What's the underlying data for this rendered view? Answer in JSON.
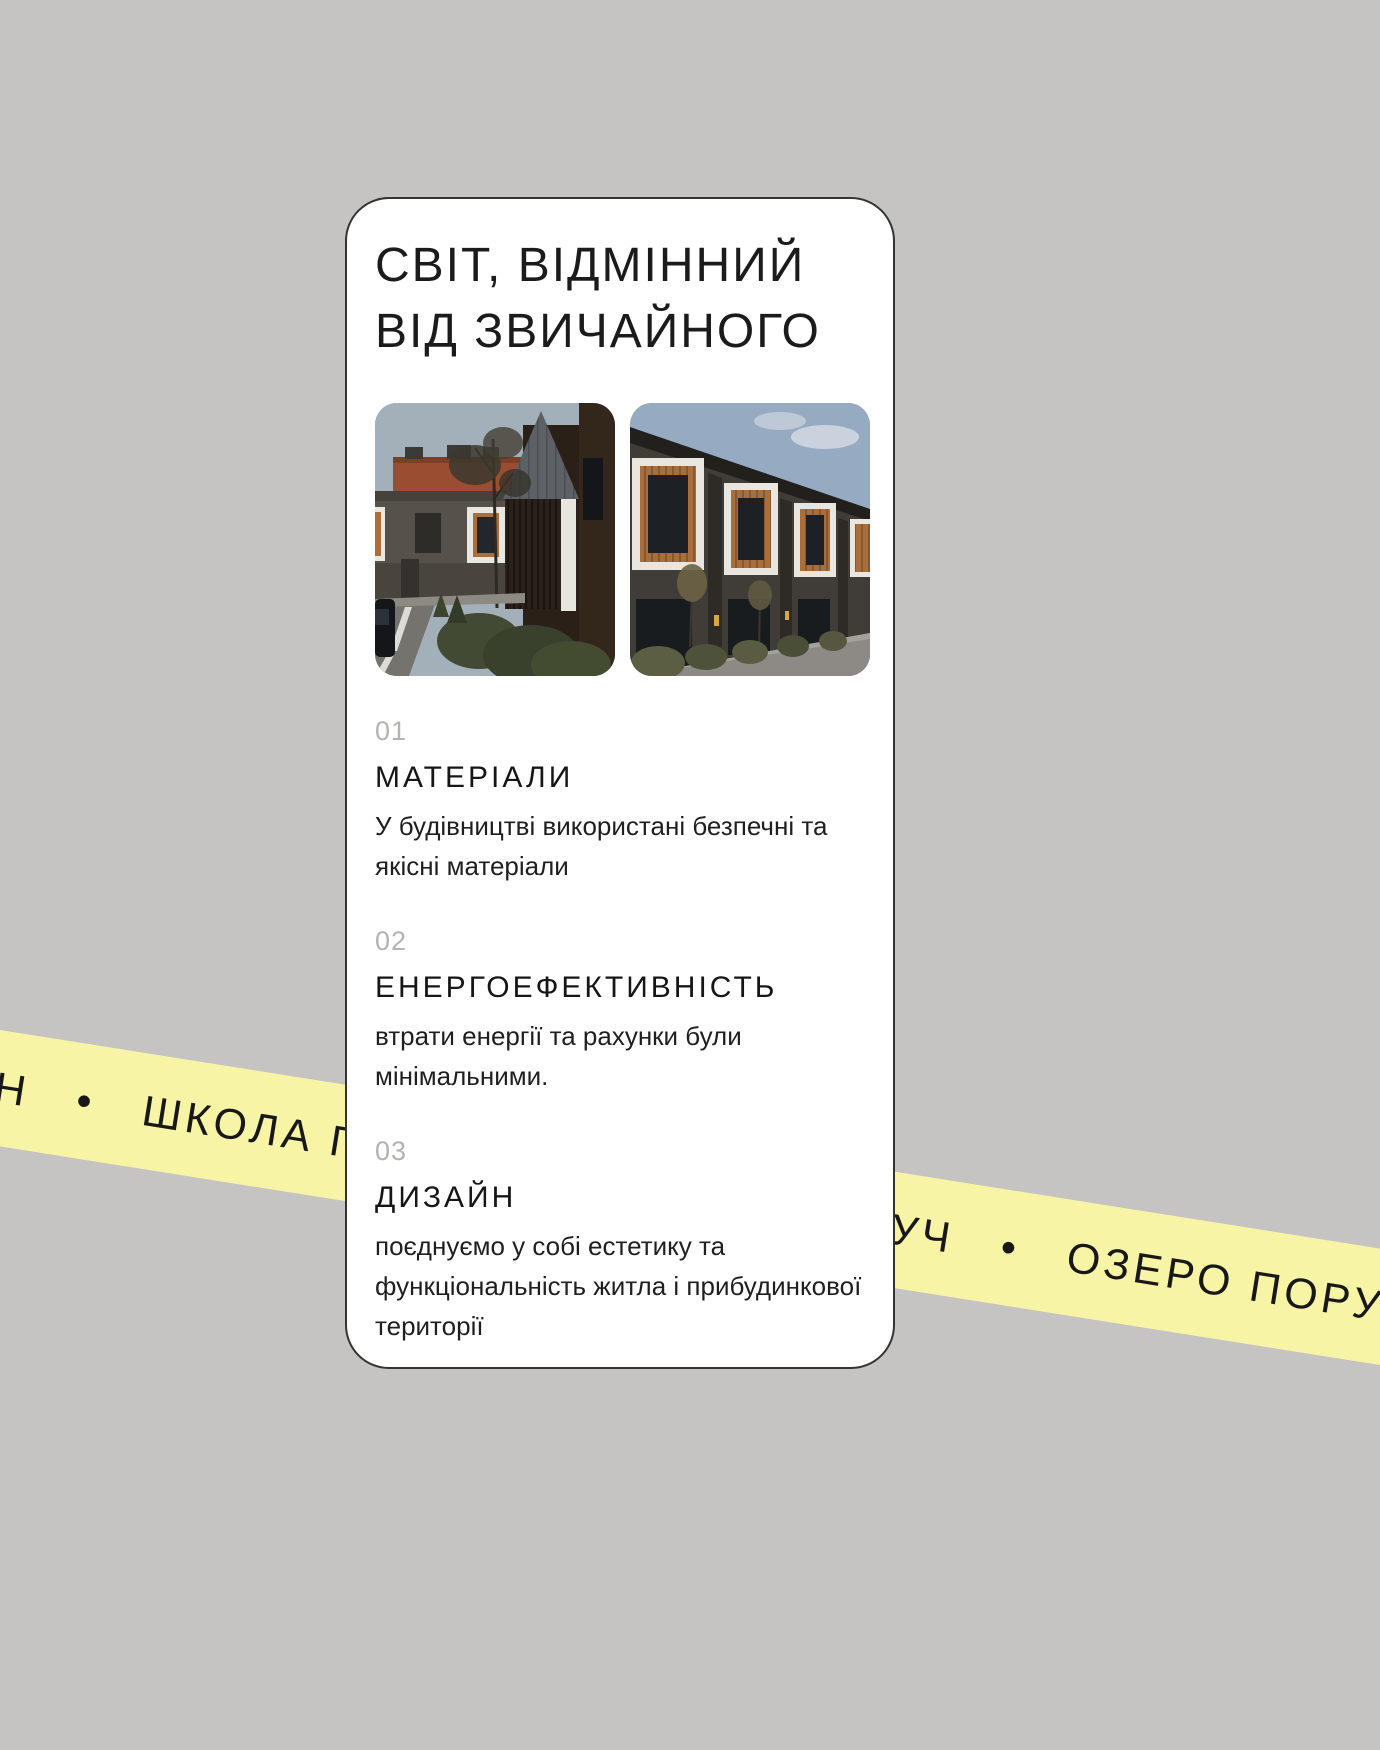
{
  "page": {
    "background_color": "#c5c4c2"
  },
  "ribbon": {
    "color": "#f8f4a6",
    "text_color": "#181818",
    "left_text": "Н   •   ШКОЛА ПОРУЧ",
    "right_text": "УЧ   •   ОЗЕРО ПОРУЧ",
    "visible_fragments": [
      "Н • ШКОЛА ПО",
      "УЧ • ОЗЕРО ПО"
    ]
  },
  "card": {
    "title": "СВІТ, ВІДМІННИЙ ВІД ЗВИЧАЙНОГО",
    "images": [
      {
        "name": "townhouse-street-photo"
      },
      {
        "name": "townhouse-row-photo"
      }
    ],
    "sections": [
      {
        "number": "01",
        "heading": "МАТЕРІАЛИ",
        "text": "У будівництві використані безпечні та якісні матеріали"
      },
      {
        "number": "02",
        "heading": "ЕНЕРГОЕФЕКТИВНІСТЬ",
        "text": "втрати енергії та рахунки були мінімальними."
      },
      {
        "number": "03",
        "heading": "ДИЗАЙН",
        "text": "поєднуємо у собі естетику та функціональність житла і прибудинкової території"
      }
    ]
  }
}
